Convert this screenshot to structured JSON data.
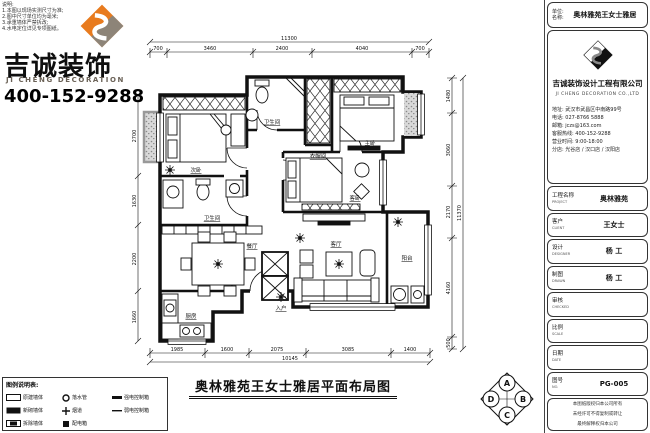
{
  "notes": {
    "lines": [
      "说明:",
      "1.本图以现场实测尺寸为准;",
      "2.图中尺寸单位均为毫米;",
      "3.承重墙体严禁拆改;",
      "4.水电定位详见专项图纸。"
    ]
  },
  "brand": {
    "name_cn": "吉诚装饰",
    "name_en": "JI CHENG DECORATION",
    "phone": "400-152-9288"
  },
  "plan": {
    "title": "奥林雅苑王女士雅居平面布局图",
    "rooms": {
      "bedroom2": "次卧",
      "bath1": "卫生间",
      "closet": "衣帽间",
      "master": "主卧",
      "bedroom3": "客卧",
      "bath2": "卫生间",
      "dining": "餐厅",
      "kitchen": "厨房",
      "living": "客厅",
      "balcony": "阳台",
      "entry": "入户"
    },
    "dims_top": {
      "segments": [
        "700",
        "3460",
        "2400",
        "4040",
        "700"
      ],
      "total": "11300"
    },
    "dims_bottom": {
      "segments": [
        "1985",
        "1600",
        "2075",
        "3085",
        "1400"
      ],
      "total": "10145"
    },
    "dims_right": {
      "segments": [
        "1480",
        "3060",
        "2170",
        "4160",
        "500"
      ],
      "total": "11370"
    },
    "dims_left": {
      "segments": [
        "2700",
        "1630",
        "2200",
        "1660"
      ]
    },
    "marker": {
      "top": "A",
      "right": "B",
      "bottom": "C",
      "left": "D"
    }
  },
  "legend": {
    "header": "图例说明表:",
    "items": [
      {
        "label": "原建墙体"
      },
      {
        "label": "落水管"
      },
      {
        "label": "强电控制箱"
      },
      {
        "label": "新砌墙体"
      },
      {
        "label": "烟道"
      },
      {
        "label": "弱电控制箱"
      },
      {
        "label": "拆除墙体"
      },
      {
        "label": "配电箱"
      }
    ]
  },
  "titleblock": {
    "header": {
      "label1": "单位:",
      "label2": "名称:",
      "value": "奥林雅苑王女士雅居"
    },
    "company": {
      "name_cn": "吉诚装饰设计工程有限公司",
      "name_en": "JI CHENG DECORATION CO.,LTD",
      "lines": [
        "地址: 武汉市武昌区中南路99号",
        "电话: 027-8766 5888",
        "邮箱: jczs@163.com",
        "客服热线: 400-152-9288",
        "营业时间: 9:00-18:00",
        "分店: 光谷店 / 汉口店 / 汉阳店"
      ]
    },
    "rows": [
      {
        "label": "工程名称",
        "sub": "PROJECT",
        "value": "奥林雅苑"
      },
      {
        "label": "客户",
        "sub": "CLIENT",
        "value": "王女士"
      },
      {
        "label": "设计",
        "sub": "DESIGNER",
        "value": "杨 工"
      },
      {
        "label": "制图",
        "sub": "DRAWN",
        "value": "杨 工"
      },
      {
        "label": "审核",
        "sub": "CHECKED",
        "value": ""
      },
      {
        "label": "比例",
        "sub": "SCALE",
        "value": ""
      },
      {
        "label": "日期",
        "sub": "DATE",
        "value": ""
      },
      {
        "label": "图号",
        "sub": "NO.",
        "value": "PG-005"
      }
    ],
    "footer": {
      "lines": [
        "本图纸版权归本公司所有",
        "未经许可不得复制或转让",
        "最终解释权归本公司"
      ]
    }
  },
  "colors": {
    "accent": "#e87b1e",
    "logo_gray": "#8d8478",
    "line": "#1a1a1a"
  }
}
